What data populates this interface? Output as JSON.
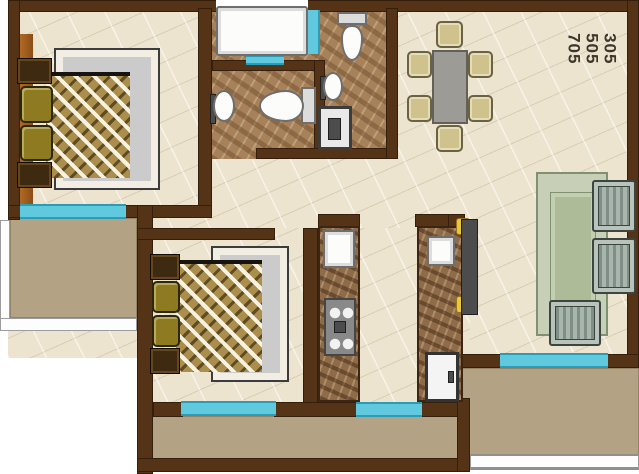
{
  "plan": {
    "type": "residential-apartment-floor-plan",
    "unit_numbers": [
      "305",
      "505",
      "705"
    ],
    "unit_numbers_text": "305\n505\n705"
  },
  "palette": {
    "wall_brown": "#543317",
    "floor_cream": "#ede4cf",
    "bathroom_marble": "#a6815a",
    "window_cyan": "#60c9de",
    "balcony_tan": "#b3a284",
    "bed_blanket_gold": "#ab8e4c",
    "pillow_olive": "#8e7b21",
    "dining_chair_khaki": "#d0c28c",
    "sofa_sage": "#b9c3bb",
    "rug_green": "#c7cfb6",
    "door_accent_yellow": "#eac63c"
  },
  "inventory": {
    "bedroom_top_left": [
      "double-bed",
      "pillows",
      "nightstands",
      "wardrobe",
      "window",
      "balcony"
    ],
    "bathroom": [
      "bathtub",
      "bath-mat",
      "toilet",
      "wash-basin"
    ],
    "wc_strip": [
      "toilet",
      "wash-basin",
      "washing-machine"
    ],
    "dining": [
      "table",
      "six-chairs"
    ],
    "kitchen": [
      "sink",
      "hob-4-burner",
      "parallel-counters",
      "refrigerator",
      "door",
      "window"
    ],
    "bedroom_bottom": [
      "double-bed",
      "pillows",
      "nightstands",
      "window",
      "balcony"
    ],
    "living": [
      "rug",
      "two-armchairs",
      "sofa",
      "window",
      "balcony"
    ]
  }
}
